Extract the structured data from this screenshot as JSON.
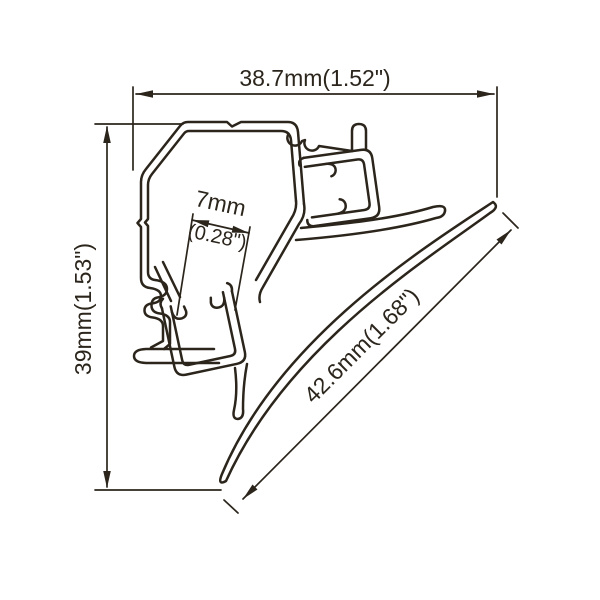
{
  "title": "LED aluminum profile cross-section technical drawing",
  "colors": {
    "background": "#ffffff",
    "line": "#2b251c"
  },
  "dimensions": {
    "top": {
      "label": "38.7mm(1.52\")"
    },
    "left": {
      "label": "39mm(1.53\")"
    },
    "inner": {
      "value_mm": "7mm",
      "value_in": "(0.28\")"
    },
    "diagonal": {
      "label": "42.6mm(1.68\")"
    }
  }
}
